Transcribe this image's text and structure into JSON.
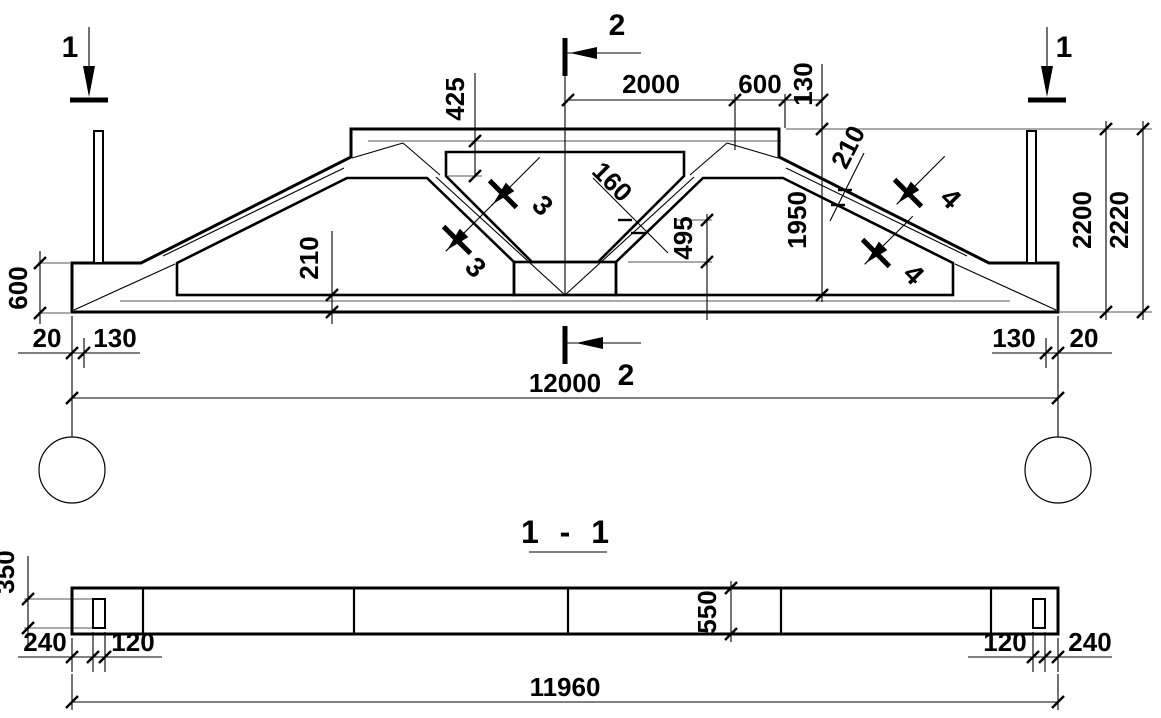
{
  "page": {
    "background": "#ffffff",
    "line_color": "#000000",
    "thin_line_color": "#8e8e8e"
  },
  "main_view": {
    "section_marks": {
      "left": "1",
      "right": "1",
      "top": "2",
      "bottom": "2",
      "strut_upper": "3",
      "strut_lower": "3",
      "chord_upper": "4",
      "chord_lower": "4"
    },
    "dims": {
      "top_half_span": "2000",
      "top_slope_run": "600",
      "top_slab_thickness": "130",
      "haunch_height": "425",
      "top_chord_thickness": "210",
      "strut_thickness": "160",
      "mid_height": "495",
      "height_to_chord_top": "1950",
      "height_to_flat": "2200",
      "overall_height": "2220",
      "left_end_offset": "20",
      "left_axis_offset": "130",
      "right_axis_offset": "130",
      "right_end_offset": "20",
      "end_block_height": "600",
      "bottom_chord_thickness": "210",
      "span": "12000"
    }
  },
  "section_view": {
    "title": "1 - 1",
    "dims": {
      "plate_height": "350",
      "beam_width": "550",
      "left_edge": "240",
      "left_plate": "120",
      "right_plate": "120",
      "right_edge": "240",
      "length": "11960"
    }
  }
}
